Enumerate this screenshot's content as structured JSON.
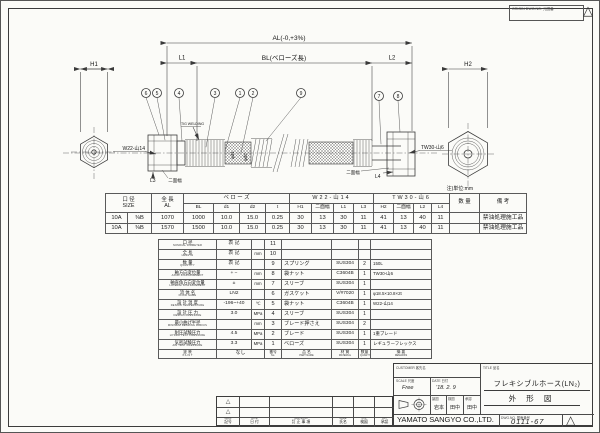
{
  "sheet": {
    "origin_label": "ORIGIN DWG.NO.  元図番",
    "rev_mark": "△"
  },
  "drawing": {
    "dim_al": "AL(-0,+3%)",
    "dim_bl": "BL(ベローズ長)",
    "dim_l1": "L1",
    "dim_l2": "L2",
    "dim_h1": "H1",
    "dim_h2": "H2",
    "dim_l3": "L3",
    "dim_l4": "L4",
    "thread_left": "W22-山14",
    "thread_right": "TW30-山6",
    "weld_note": "TIG WELDING",
    "flats_left": "二面幅",
    "flats_right": "二面幅",
    "dia1": "φd1",
    "dia2": "φd2",
    "units_note": "注)単位:mm",
    "balloons": [
      "6",
      "5",
      "4",
      "3",
      "1",
      "2",
      "9",
      "7",
      "8"
    ]
  },
  "dim_table": {
    "size_jp": "口 径",
    "size_en": "SIZE",
    "al_jp": "全 長",
    "al_en": "AL",
    "grp_bellows": "ベ ロ ー ズ",
    "grp_w22": "W22-山14",
    "grp_tw30": "TW30-山6",
    "qty": "数 量",
    "rem": "備 考",
    "sub": [
      "BL",
      "d1",
      "d2",
      "t",
      "H1",
      "二面幅",
      "L1",
      "L3",
      "H2",
      "二面幅",
      "L2",
      "L4"
    ],
    "rows": [
      [
        "10A",
        "⅜B",
        "1070",
        "1000",
        "10.0",
        "15.0",
        "0.25",
        "30",
        "13",
        "30",
        "11",
        "41",
        "13",
        "40",
        "11",
        "",
        "禁油処理施工品"
      ],
      [
        "10A",
        "⅜B",
        "1570",
        "1500",
        "10.0",
        "15.0",
        "0.25",
        "30",
        "13",
        "30",
        "11",
        "41",
        "13",
        "40",
        "11",
        "",
        "禁油処理施工品"
      ]
    ]
  },
  "spec_rows": [
    {
      "jp": "口 径",
      "en": "NOMINAL DIAMETER",
      "val": "表 記",
      "unit": "",
      "no": "11",
      "name": "",
      "mat": "",
      "qty": "",
      "rem": ""
    },
    {
      "jp": "全 長",
      "en": "LENGTH",
      "val": "表 記",
      "unit": "mm",
      "no": "10",
      "name": "",
      "mat": "",
      "qty": "",
      "rem": ""
    },
    {
      "jp": "数 量",
      "en": "QUANTITY",
      "val": "表 記",
      "unit": "",
      "no": "9",
      "name": "スプリング",
      "mat": "SUS304",
      "qty": "2",
      "rem": "150L"
    },
    {
      "jp": "軸方向変位量",
      "en": "AXIAL DISPLACEMENT",
      "val": "+  −",
      "unit": "mm",
      "no": "8",
      "name": "袋ナット",
      "mat": "C3604B",
      "qty": "1",
      "rem": "TW30-山6"
    },
    {
      "jp": "軸直角方向変位量",
      "en": "LATERAL DISPLACEMENT",
      "val": "±",
      "unit": "mm",
      "no": "7",
      "name": "スリーブ",
      "mat": "SUS304",
      "qty": "1",
      "rem": ""
    },
    {
      "jp": "流 体 名",
      "en": "FLUID NAME",
      "val": "LN2",
      "unit": "",
      "no": "6",
      "name": "ガスケット",
      "mat": "V/#7020",
      "qty": "1",
      "rem": "φ18.5×10.8×2t"
    },
    {
      "jp": "設 計 温 度",
      "en": "DESIGN TEMPERATURE",
      "val": "-196~+40",
      "unit": "℃",
      "no": "5",
      "name": "袋ナット",
      "mat": "C3604B",
      "qty": "1",
      "rem": "W22-山14"
    },
    {
      "jp": "設 計 圧 力",
      "en": "DESIGN PRESSURE",
      "val": "3.0",
      "unit": "MPa",
      "no": "4",
      "name": "スリーブ",
      "mat": "SUS304",
      "qty": "1",
      "rem": ""
    },
    {
      "jp": "最小曲げ半径",
      "en": "MINIMUM BENDING RADIUS",
      "val": "",
      "unit": "mm",
      "no": "3",
      "name": "ブレード押さえ",
      "mat": "SUS304",
      "qty": "2",
      "rem": ""
    },
    {
      "jp": "耐圧試験圧力",
      "en": "HYDRO TEST PRESSURE",
      "val": "4.5",
      "unit": "MPa",
      "no": "2",
      "name": "ブレード",
      "mat": "SUS304",
      "qty": "1",
      "rem": "1重ブレード"
    },
    {
      "jp": "気密試験圧力",
      "en": "AIR TEST PRESSURE",
      "val": "3.3",
      "unit": "MPa",
      "no": "1",
      "name": "ベローズ",
      "mat": "SUS304",
      "qty": "1",
      "rem": "レギュラーフレックス"
    }
  ],
  "parts_footer": {
    "paint_jp": "塗 装",
    "paint_en": "P A I N T",
    "paint_val": "なし",
    "no_jp": "番号",
    "no_en": "No.",
    "name_jp": "品 名",
    "name_en": "PART NAME",
    "mat_jp": "材 質",
    "mat_en": "MATERIAL",
    "qty_jp": "数量",
    "qty_en": "QUANTITY",
    "rem_jp": "摘 要",
    "rem_en": "REMARKS"
  },
  "title_block": {
    "customer_label": "CUSTOMER  客先名",
    "title_label": "TITLE  品名",
    "title_line1": "フレキシブルホース(LN₂)",
    "title_line2": "外 形 図",
    "scale_label": "SCALE 尺度",
    "scale_value": "Free",
    "date_label": "DATE 日付",
    "date_value": "'18. 2. 9",
    "drawn_label": "製図",
    "drawn_name": "岩本",
    "checked_label": "検図",
    "checked_name": "田中",
    "approved_label": "承認",
    "approved_name": "田中",
    "company": "YAMATO SANGYO CO.,LTD.",
    "dwg_no_label": "DWG.NO.  図面番号",
    "dwg_no": "0111-67",
    "rev_mark": "△"
  },
  "revision": {
    "marks": [
      "△",
      "△"
    ],
    "headers": [
      {
        "en": "MARK",
        "jp": "記号"
      },
      {
        "en": "DATE",
        "jp": "日 付"
      },
      {
        "en": "REVISIONS",
        "jp": "訂 正 事 項"
      },
      {
        "en": "NAME",
        "jp": "氏名"
      },
      {
        "en": "CHK",
        "jp": "検図"
      },
      {
        "en": "APV",
        "jp": "承認"
      }
    ]
  }
}
